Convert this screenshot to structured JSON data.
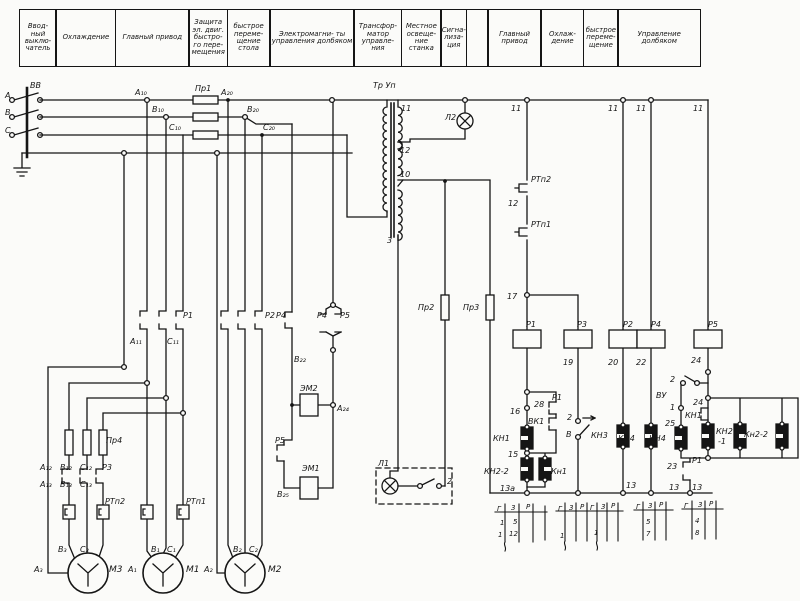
{
  "header": {
    "cells": [
      {
        "label": "Ввод- ный выклю- чатель",
        "w": 38
      },
      {
        "label": "Охлаждение",
        "w": 61
      },
      {
        "label": "Главный привод",
        "w": 75
      },
      {
        "label": "Защита эл. двиг. быстро- го пере- мещения",
        "w": 40
      },
      {
        "label": "быстрое переме- щение стола",
        "w": 44
      },
      {
        "label": "Электромагни- ты управления долбяком",
        "w": 86
      },
      {
        "label": "Трансфор- матор управле- ния",
        "w": 49
      },
      {
        "label": "Местное освеще- ние станка",
        "w": 41
      },
      {
        "label": "Сигна- лиза- ция",
        "w": 27
      },
      {
        "label": "",
        "w": 23
      },
      {
        "label": "Главный привод",
        "w": 55
      },
      {
        "label": "Охлаж- дение",
        "w": 44
      },
      {
        "label": "быстрое переме- щение",
        "w": 36
      },
      {
        "label": "Управление долбяком",
        "w": 84
      }
    ]
  },
  "schematic": {
    "labels": [
      {
        "t": "А",
        "x": 5,
        "y": 98
      },
      {
        "t": "В",
        "x": 5,
        "y": 115
      },
      {
        "t": "С",
        "x": 5,
        "y": 133
      },
      {
        "t": "ВВ",
        "x": 30,
        "y": 88
      },
      {
        "t": "А₁₀",
        "x": 135,
        "y": 95
      },
      {
        "t": "В₁₀",
        "x": 152,
        "y": 112
      },
      {
        "t": "С₁₀",
        "x": 169,
        "y": 130
      },
      {
        "t": "Пр1",
        "x": 195,
        "y": 91
      },
      {
        "t": "А₂₀",
        "x": 221,
        "y": 95
      },
      {
        "t": "В₂₀",
        "x": 247,
        "y": 112
      },
      {
        "t": "С₂₀",
        "x": 263,
        "y": 130
      },
      {
        "t": "Тр Уп",
        "x": 373,
        "y": 88
      },
      {
        "t": "11",
        "x": 401,
        "y": 111
      },
      {
        "t": "12",
        "x": 400,
        "y": 153
      },
      {
        "t": "10",
        "x": 400,
        "y": 177
      },
      {
        "t": "3",
        "x": 387,
        "y": 243
      },
      {
        "t": "Л2",
        "x": 445,
        "y": 120
      },
      {
        "t": "11",
        "x": 511,
        "y": 111
      },
      {
        "t": "11",
        "x": 608,
        "y": 111
      },
      {
        "t": "11",
        "x": 636,
        "y": 111
      },
      {
        "t": "11",
        "x": 693,
        "y": 111
      },
      {
        "t": "РТп2",
        "x": 531,
        "y": 182
      },
      {
        "t": "12",
        "x": 508,
        "y": 206
      },
      {
        "t": "РТп1",
        "x": 531,
        "y": 227
      },
      {
        "t": "17",
        "x": 507,
        "y": 299
      },
      {
        "t": "Р1",
        "x": 526,
        "y": 327
      },
      {
        "t": "Р3",
        "x": 577,
        "y": 327
      },
      {
        "t": "Р2",
        "x": 623,
        "y": 327
      },
      {
        "t": "Р4",
        "x": 651,
        "y": 327
      },
      {
        "t": "Р5",
        "x": 708,
        "y": 327
      },
      {
        "t": "19",
        "x": 563,
        "y": 365
      },
      {
        "t": "20",
        "x": 608,
        "y": 365
      },
      {
        "t": "22",
        "x": 636,
        "y": 365
      },
      {
        "t": "24",
        "x": 691,
        "y": 363
      },
      {
        "t": "16",
        "x": 510,
        "y": 414
      },
      {
        "t": "28",
        "x": 534,
        "y": 407
      },
      {
        "t": "Р1",
        "x": 552,
        "y": 400
      },
      {
        "t": "ВК1",
        "x": 528,
        "y": 424
      },
      {
        "t": "КН1",
        "x": 493,
        "y": 441
      },
      {
        "t": "15",
        "x": 508,
        "y": 457
      },
      {
        "t": "КН2-2",
        "x": 484,
        "y": 474
      },
      {
        "t": "Кн1",
        "x": 551,
        "y": 474
      },
      {
        "t": "13а",
        "x": 500,
        "y": 491
      },
      {
        "t": "2",
        "x": 567,
        "y": 420
      },
      {
        "t": "В",
        "x": 566,
        "y": 437
      },
      {
        "t": "КН3",
        "x": 591,
        "y": 438
      },
      {
        "t": "КН4",
        "x": 618,
        "y": 441
      },
      {
        "t": "13",
        "x": 626,
        "y": 488
      },
      {
        "t": "2",
        "x": 670,
        "y": 382
      },
      {
        "t": "ВУ",
        "x": 656,
        "y": 398
      },
      {
        "t": "1",
        "x": 670,
        "y": 410
      },
      {
        "t": "24",
        "x": 693,
        "y": 405
      },
      {
        "t": "КН1",
        "x": 685,
        "y": 418
      },
      {
        "t": "25",
        "x": 665,
        "y": 426
      },
      {
        "t": "КН4",
        "x": 649,
        "y": 441
      },
      {
        "t": "КН2",
        "x": 716,
        "y": 434
      },
      {
        "t": "-1",
        "x": 718,
        "y": 444
      },
      {
        "t": "Кн2-2",
        "x": 744,
        "y": 437
      },
      {
        "t": "23",
        "x": 667,
        "y": 469
      },
      {
        "t": "Р1",
        "x": 692,
        "y": 463
      },
      {
        "t": "13",
        "x": 669,
        "y": 490
      },
      {
        "t": "13",
        "x": 692,
        "y": 490
      },
      {
        "t": "Пр2",
        "x": 418,
        "y": 310
      },
      {
        "t": "Пр3",
        "x": 463,
        "y": 310
      },
      {
        "t": "Л1",
        "x": 378,
        "y": 466
      },
      {
        "t": "2",
        "x": 447,
        "y": 484
      },
      {
        "t": "Р1",
        "x": 183,
        "y": 318
      },
      {
        "t": "А₁₁",
        "x": 130,
        "y": 344
      },
      {
        "t": "С₁₁",
        "x": 167,
        "y": 344
      },
      {
        "t": "Р2",
        "x": 265,
        "y": 318
      },
      {
        "t": "Р4",
        "x": 276,
        "y": 318
      },
      {
        "t": "Р4",
        "x": 317,
        "y": 318
      },
      {
        "t": "Р5",
        "x": 340,
        "y": 318
      },
      {
        "t": "В₂₂",
        "x": 294,
        "y": 362
      },
      {
        "t": "ЭМ2",
        "x": 300,
        "y": 391
      },
      {
        "t": "А₂₄",
        "x": 337,
        "y": 411
      },
      {
        "t": "Р5",
        "x": 275,
        "y": 443
      },
      {
        "t": "ЭМ1",
        "x": 302,
        "y": 471
      },
      {
        "t": "В₂₅",
        "x": 277,
        "y": 497
      },
      {
        "t": "Пр4",
        "x": 106,
        "y": 443
      },
      {
        "t": "А₁₂",
        "x": 40,
        "y": 470
      },
      {
        "t": "В₁₂",
        "x": 60,
        "y": 470
      },
      {
        "t": "С₁₂",
        "x": 80,
        "y": 470
      },
      {
        "t": "Р3",
        "x": 102,
        "y": 470
      },
      {
        "t": "А₁₃",
        "x": 40,
        "y": 487
      },
      {
        "t": "В₁₃",
        "x": 60,
        "y": 487
      },
      {
        "t": "С₁₃",
        "x": 80,
        "y": 487
      },
      {
        "t": "РТп2",
        "x": 105,
        "y": 504
      },
      {
        "t": "РТп1",
        "x": 186,
        "y": 504
      },
      {
        "t": "В₃",
        "x": 58,
        "y": 552
      },
      {
        "t": "С₃",
        "x": 80,
        "y": 552
      },
      {
        "t": "А₃",
        "x": 34,
        "y": 572
      },
      {
        "t": "М3",
        "x": 109,
        "y": 572,
        "fs": 9
      },
      {
        "t": "В₁",
        "x": 151,
        "y": 552
      },
      {
        "t": "С₁",
        "x": 167,
        "y": 552
      },
      {
        "t": "А₁",
        "x": 128,
        "y": 572
      },
      {
        "t": "М1",
        "x": 186,
        "y": 572,
        "fs": 9
      },
      {
        "t": "В₂",
        "x": 233,
        "y": 552
      },
      {
        "t": "С₂",
        "x": 249,
        "y": 552
      },
      {
        "t": "А₂",
        "x": 204,
        "y": 572
      },
      {
        "t": "М2",
        "x": 268,
        "y": 572,
        "fs": 9
      },
      {
        "t": "Г",
        "x": 497,
        "y": 511,
        "fs": 7
      },
      {
        "t": "3",
        "x": 511,
        "y": 510,
        "fs": 7
      },
      {
        "t": "Р",
        "x": 526,
        "y": 509,
        "fs": 7
      },
      {
        "t": "1",
        "x": 500,
        "y": 525,
        "fs": 7
      },
      {
        "t": "5",
        "x": 513,
        "y": 524,
        "fs": 7
      },
      {
        "t": "1",
        "x": 498,
        "y": 537,
        "fs": 7
      },
      {
        "t": "12",
        "x": 509,
        "y": 536,
        "fs": 7
      },
      {
        "t": "Г",
        "x": 558,
        "y": 511,
        "fs": 7
      },
      {
        "t": "3",
        "x": 569,
        "y": 510,
        "fs": 7
      },
      {
        "t": "Р",
        "x": 580,
        "y": 509,
        "fs": 7
      },
      {
        "t": "Г",
        "x": 590,
        "y": 510,
        "fs": 7
      },
      {
        "t": "3",
        "x": 601,
        "y": 509,
        "fs": 7
      },
      {
        "t": "Р",
        "x": 611,
        "y": 508,
        "fs": 7
      },
      {
        "t": "1",
        "x": 560,
        "y": 538,
        "fs": 7
      },
      {
        "t": "1",
        "x": 594,
        "y": 535,
        "fs": 7
      },
      {
        "t": "Г",
        "x": 636,
        "y": 509,
        "fs": 7
      },
      {
        "t": "3",
        "x": 648,
        "y": 508,
        "fs": 7
      },
      {
        "t": "Р",
        "x": 659,
        "y": 507,
        "fs": 7
      },
      {
        "t": "5",
        "x": 646,
        "y": 524,
        "fs": 7
      },
      {
        "t": "7",
        "x": 646,
        "y": 536,
        "fs": 7
      },
      {
        "t": "Г",
        "x": 684,
        "y": 508,
        "fs": 7
      },
      {
        "t": "3",
        "x": 698,
        "y": 507,
        "fs": 7
      },
      {
        "t": "Р",
        "x": 709,
        "y": 506,
        "fs": 7
      },
      {
        "t": "4",
        "x": 695,
        "y": 523,
        "fs": 7
      },
      {
        "t": "8",
        "x": 695,
        "y": 535,
        "fs": 7
      }
    ]
  }
}
